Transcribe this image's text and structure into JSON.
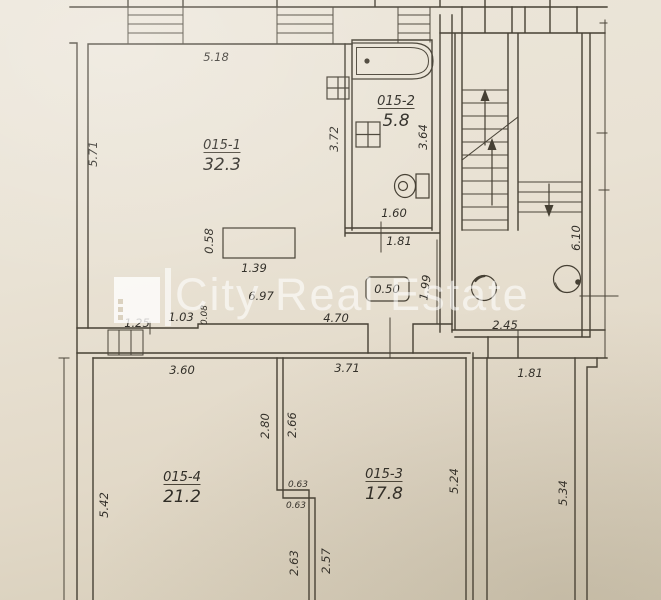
{
  "watermark": {
    "text": "City Real Estate"
  },
  "rooms": {
    "living": {
      "id": "015-1",
      "area": "32.3"
    },
    "bathroom": {
      "id": "015-2",
      "area": "5.8"
    },
    "room3": {
      "id": "015-3",
      "area": "17.8"
    },
    "room4": {
      "id": "015-4",
      "area": "21.2"
    }
  },
  "dimensions": {
    "room1_top": "5.18",
    "room1_left": "5.71",
    "bath_left": "3.72",
    "bath_right": "3.64",
    "bath_inner_width": "1.60",
    "bath_outer_width": "1.81",
    "counter_depth": "0.58",
    "counter_width": "1.39",
    "hall_width": "6.97",
    "seg_left": "1.25",
    "seg_mid": "1.03",
    "wall_jog": "0.08",
    "hall_right_width": "4.70",
    "niche_box": "0.50",
    "hall_height": "1.99",
    "landing_width": "2.45",
    "stair_height": "6.10",
    "room4_top": "3.60",
    "room3_top": "3.71",
    "strip_top": "1.81",
    "divider_upper_left": "2.80",
    "divider_upper_right": "2.66",
    "divider_jog_upper": "0.63",
    "divider_jog_lower": "0.63",
    "room4_left": "5.42",
    "room3_right": "5.24",
    "strip_right": "5.34",
    "divider_lower_left": "2.63",
    "divider_lower_right": "2.57"
  },
  "colors": {
    "paper": "#e9e2d4",
    "line": "#464034",
    "watermark": "#ffffff"
  }
}
